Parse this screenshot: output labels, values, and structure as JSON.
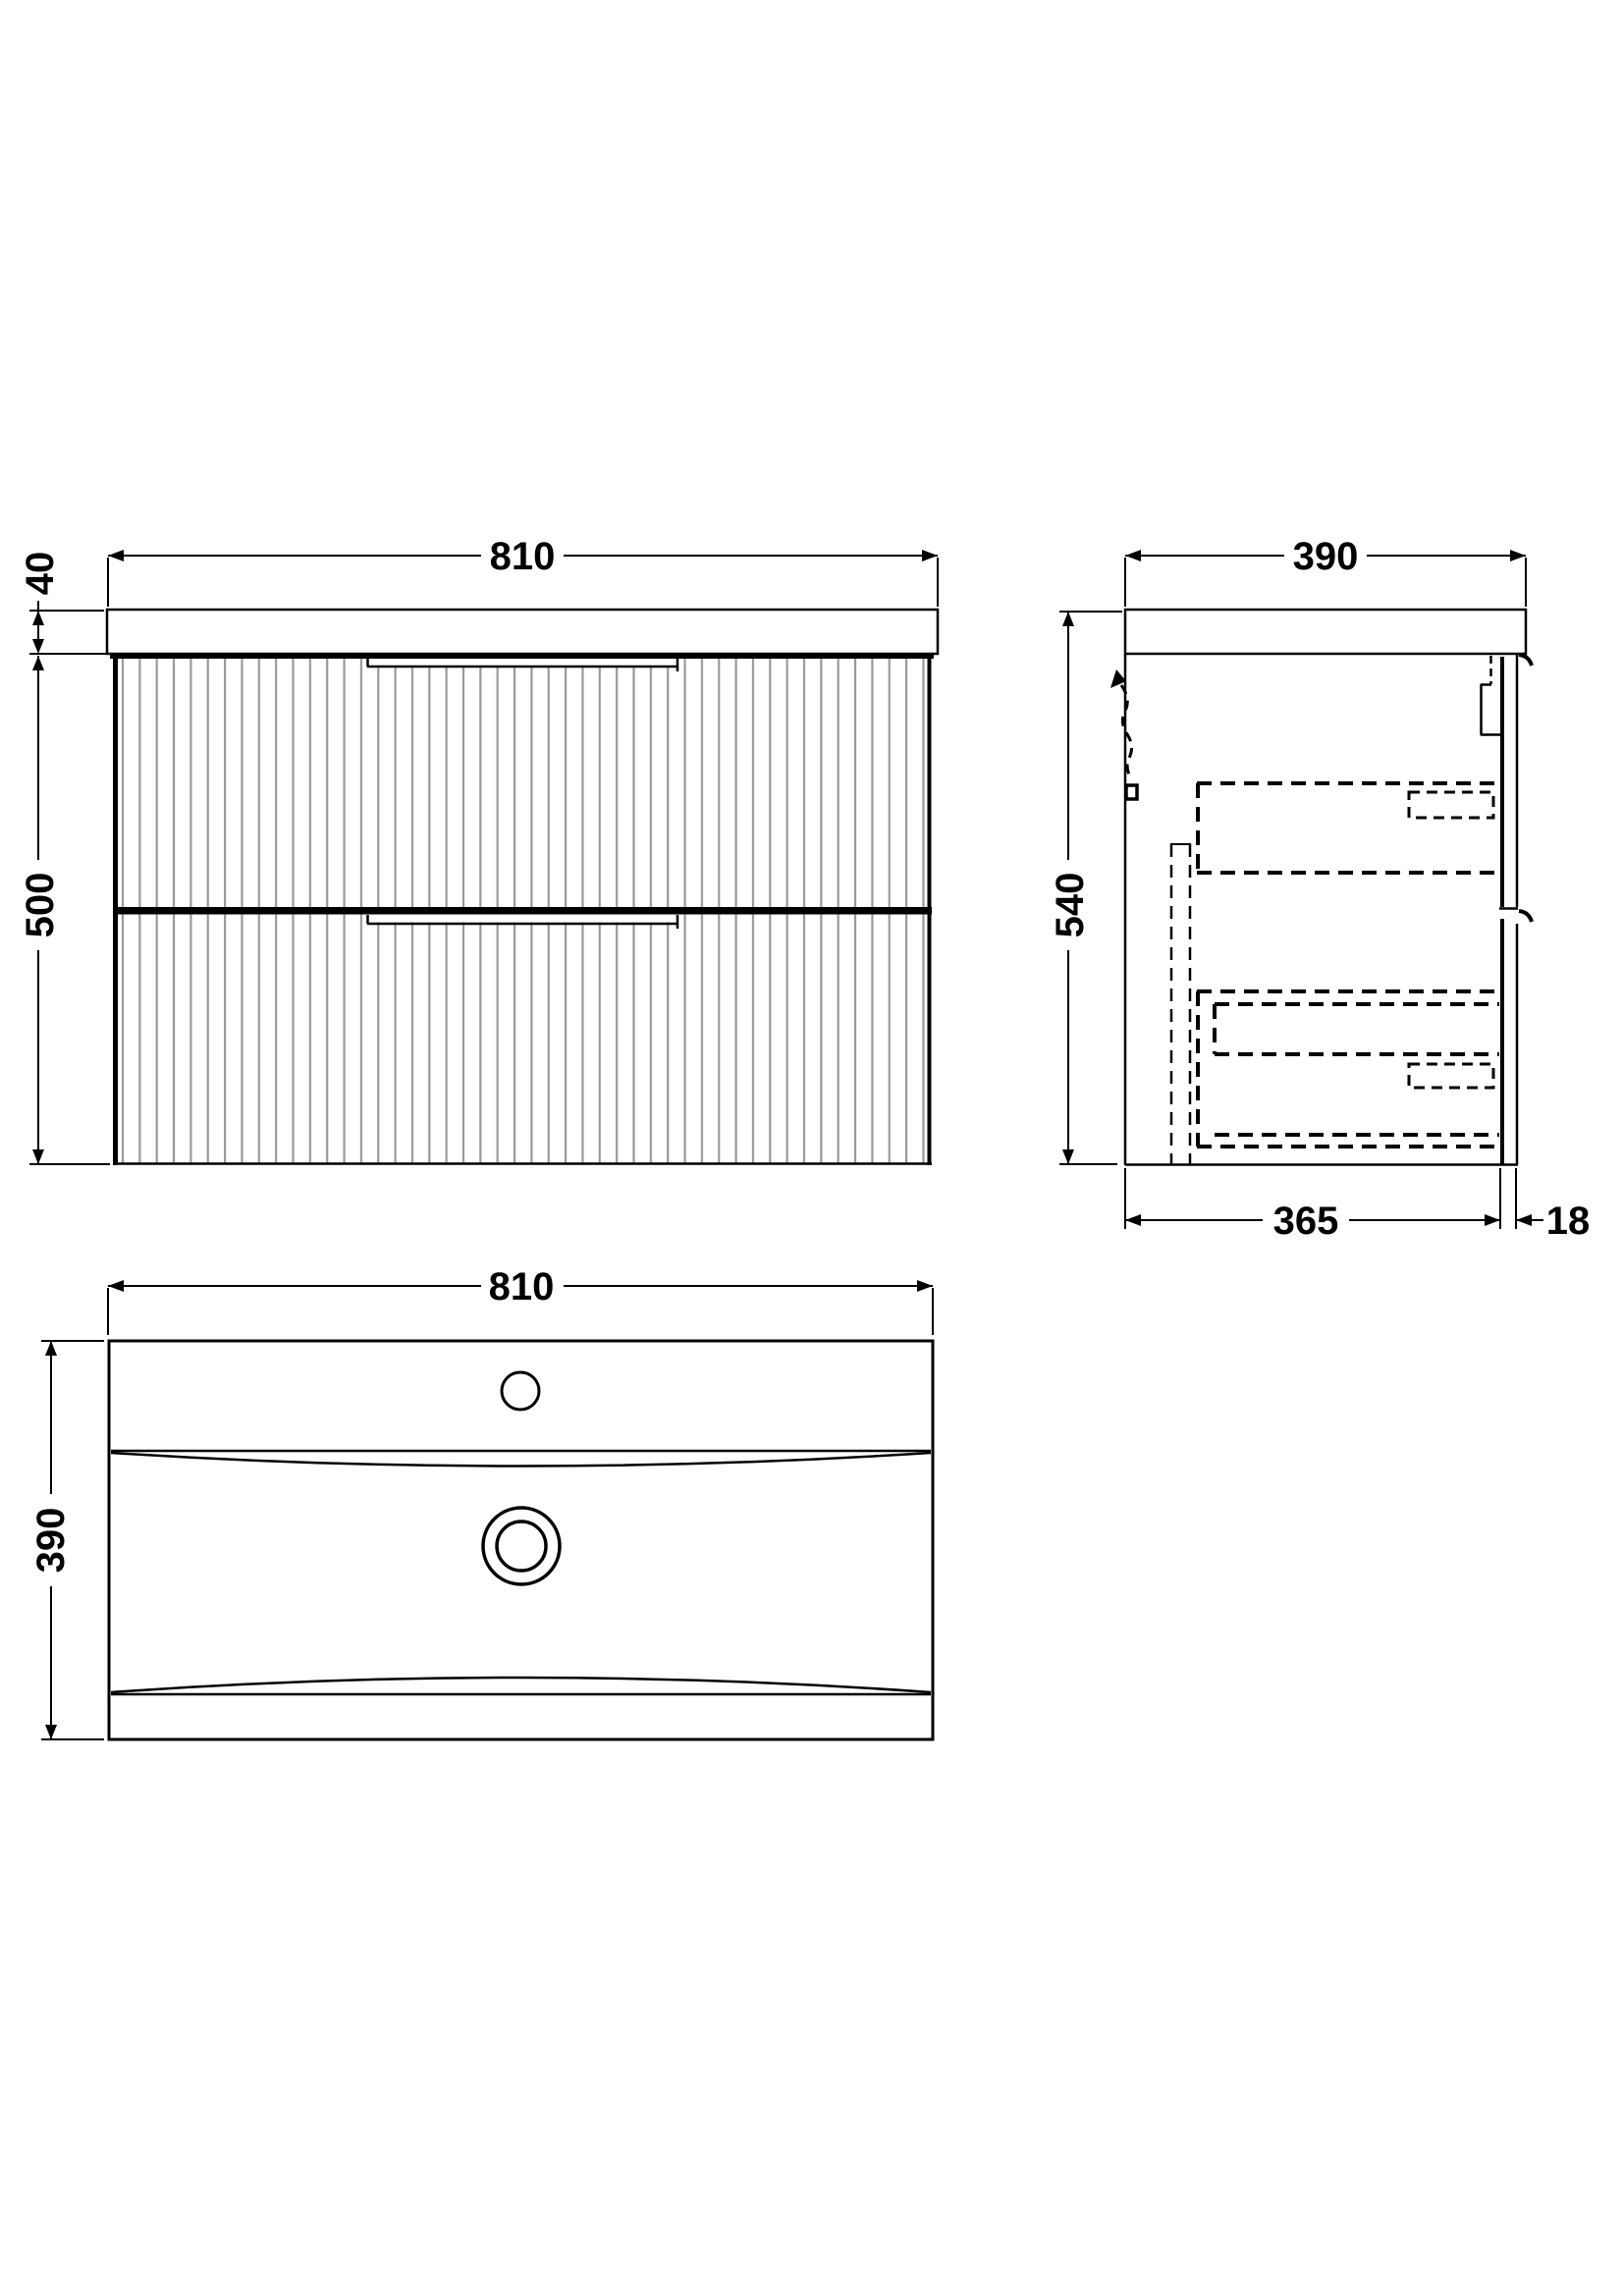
{
  "drawing": {
    "front_view": {
      "width_label": "810",
      "basin_height_label": "40",
      "cabinet_height_label": "500"
    },
    "side_view": {
      "depth_label": "390",
      "total_height_label": "540",
      "carcass_depth_label": "365",
      "front_panel_thickness_label": "18"
    },
    "plan_view": {
      "width_label": "810",
      "depth_label": "390"
    }
  },
  "colors": {
    "line": "#000000",
    "flute": "#999999",
    "background": "#ffffff"
  }
}
